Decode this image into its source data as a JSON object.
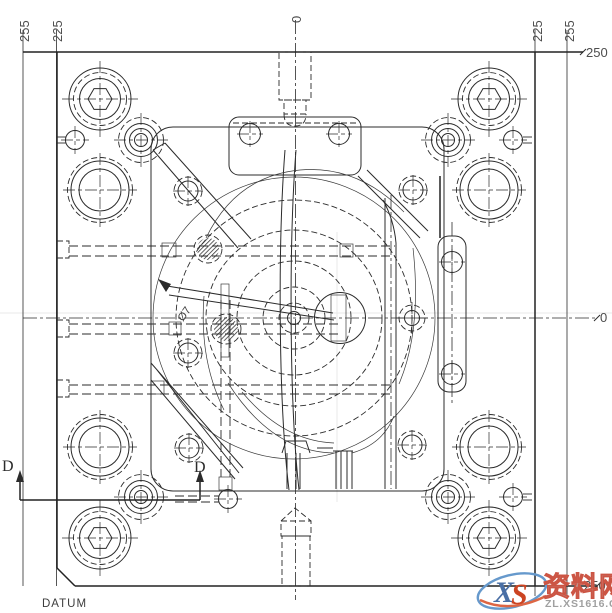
{
  "drawing": {
    "dimensions": {
      "left_outer": "255",
      "left_inner": "225",
      "center_zero": "0",
      "right_inner": "225",
      "right_outer": "255",
      "top_right": "250",
      "bottom_right": "250",
      "right_zero": "0"
    },
    "section": {
      "d_left": "D",
      "d_right": "D"
    },
    "datum_label": "DATUM",
    "annotations": {
      "runner_dia": "Ø7"
    },
    "colors": {
      "line": "#2b2b2b",
      "dim_text": "#4d4d4d",
      "faint_guide": "#e8e8e8"
    }
  },
  "watermark": {
    "logo_x": "X",
    "logo_s": "S",
    "site_name": "资料网",
    "site_url": "ZL.XS1616.COM",
    "colors": {
      "x": "#4a6fa5",
      "s": "#cc4422",
      "name_fill": "#b8b8b8",
      "name_stroke": "#cc5544",
      "url": "#a0a0a0",
      "oval_blue": "#6699cc",
      "oval_red": "#dd6644"
    }
  }
}
